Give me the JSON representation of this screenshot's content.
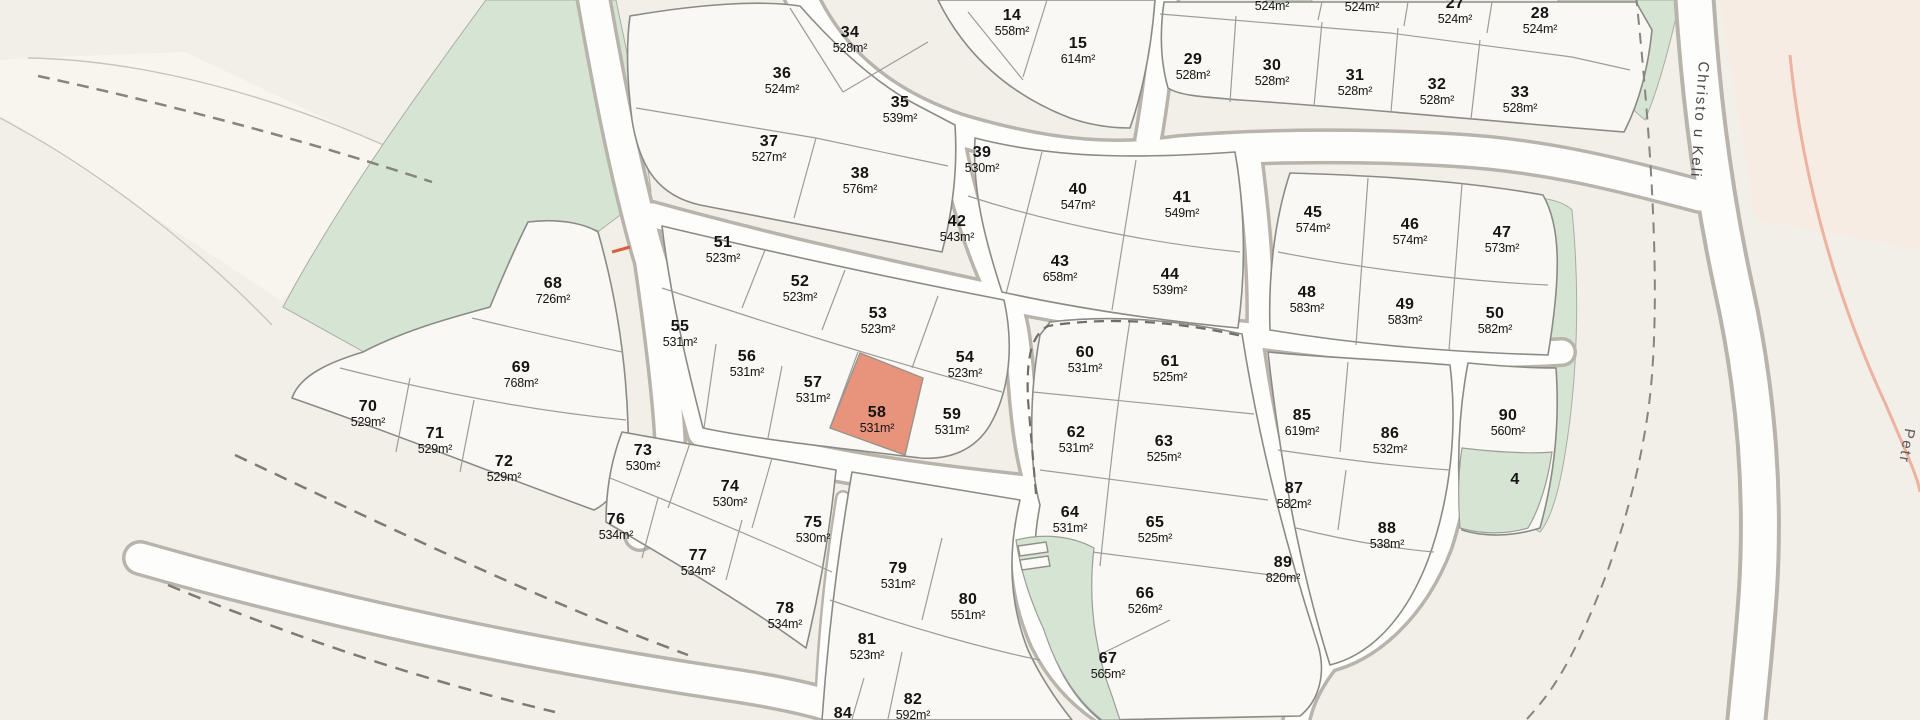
{
  "map": {
    "title": "Parcel subdivision map",
    "colors": {
      "background": "#f2efe9",
      "plot_fill": "#f9f8f4",
      "greenspace": "#d6e4d3",
      "road_fill": "#fdfdfc",
      "road_casing": "#b8b4ab",
      "highlight_fill": "#e8937c",
      "dashed_boundary": "#7c7c76",
      "construction_road_pink": "#edb2a0"
    },
    "highlighted_plot": "58",
    "street_labels": {
      "christo": "Christo u Keli",
      "petr": "Petr"
    },
    "plots": [
      {
        "num": "34",
        "area": "528m²",
        "x": 850,
        "y": 33
      },
      {
        "num": "36",
        "area": "524m²",
        "x": 782,
        "y": 74
      },
      {
        "num": "35",
        "area": "539m²",
        "x": 900,
        "y": 103
      },
      {
        "num": "37",
        "area": "527m²",
        "x": 769,
        "y": 142
      },
      {
        "num": "38",
        "area": "576m²",
        "x": 860,
        "y": 174
      },
      {
        "num": "14",
        "area": "558m²",
        "x": 1012,
        "y": 16
      },
      {
        "num": "15",
        "area": "614m²",
        "x": 1078,
        "y": 44
      },
      {
        "num": null,
        "area": "524m²",
        "x": 1272,
        "y": 8
      },
      {
        "num": "26",
        "area": "524m²",
        "x": 1362,
        "y": -8
      },
      {
        "num": "27",
        "area": "524m²",
        "x": 1455,
        "y": 4
      },
      {
        "num": "28",
        "area": "524m²",
        "x": 1540,
        "y": 14
      },
      {
        "num": "29",
        "area": "528m²",
        "x": 1193,
        "y": 60
      },
      {
        "num": "30",
        "area": "528m²",
        "x": 1272,
        "y": 66
      },
      {
        "num": "31",
        "area": "528m²",
        "x": 1355,
        "y": 76
      },
      {
        "num": "32",
        "area": "528m²",
        "x": 1437,
        "y": 85
      },
      {
        "num": "33",
        "area": "528m²",
        "x": 1520,
        "y": 93
      },
      {
        "num": "39",
        "area": "530m²",
        "x": 982,
        "y": 153
      },
      {
        "num": "42",
        "area": "543m²",
        "x": 957,
        "y": 222
      },
      {
        "num": "40",
        "area": "547m²",
        "x": 1078,
        "y": 190
      },
      {
        "num": "43",
        "area": "658m²",
        "x": 1060,
        "y": 262
      },
      {
        "num": "41",
        "area": "549m²",
        "x": 1182,
        "y": 198
      },
      {
        "num": "44",
        "area": "539m²",
        "x": 1170,
        "y": 275
      },
      {
        "num": "45",
        "area": "574m²",
        "x": 1313,
        "y": 213
      },
      {
        "num": "46",
        "area": "574m²",
        "x": 1410,
        "y": 225
      },
      {
        "num": "47",
        "area": "573m²",
        "x": 1502,
        "y": 233
      },
      {
        "num": "48",
        "area": "583m²",
        "x": 1307,
        "y": 293
      },
      {
        "num": "49",
        "area": "583m²",
        "x": 1405,
        "y": 305
      },
      {
        "num": "50",
        "area": "582m²",
        "x": 1495,
        "y": 314
      },
      {
        "num": "51",
        "area": "523m²",
        "x": 723,
        "y": 243
      },
      {
        "num": "52",
        "area": "523m²",
        "x": 800,
        "y": 282
      },
      {
        "num": "53",
        "area": "523m²",
        "x": 878,
        "y": 314
      },
      {
        "num": "54",
        "area": "523m²",
        "x": 965,
        "y": 358
      },
      {
        "num": "55",
        "area": "531m²",
        "x": 680,
        "y": 327
      },
      {
        "num": "56",
        "area": "531m²",
        "x": 747,
        "y": 357
      },
      {
        "num": "57",
        "area": "531m²",
        "x": 813,
        "y": 383
      },
      {
        "num": "58",
        "area": "531m²",
        "x": 877,
        "y": 413,
        "highlight": true
      },
      {
        "num": "59",
        "area": "531m²",
        "x": 952,
        "y": 415
      },
      {
        "num": "60",
        "area": "531m²",
        "x": 1085,
        "y": 353
      },
      {
        "num": "61",
        "area": "525m²",
        "x": 1170,
        "y": 362
      },
      {
        "num": "62",
        "area": "531m²",
        "x": 1076,
        "y": 433
      },
      {
        "num": "63",
        "area": "525m²",
        "x": 1164,
        "y": 442
      },
      {
        "num": "64",
        "area": "531m²",
        "x": 1070,
        "y": 513
      },
      {
        "num": "65",
        "area": "525m²",
        "x": 1155,
        "y": 523
      },
      {
        "num": "66",
        "area": "526m²",
        "x": 1145,
        "y": 594
      },
      {
        "num": "67",
        "area": "565m²",
        "x": 1108,
        "y": 659
      },
      {
        "num": "68",
        "area": "726m²",
        "x": 553,
        "y": 284
      },
      {
        "num": "69",
        "area": "768m²",
        "x": 521,
        "y": 368
      },
      {
        "num": "70",
        "area": "529m²",
        "x": 368,
        "y": 407
      },
      {
        "num": "71",
        "area": "529m²",
        "x": 435,
        "y": 434
      },
      {
        "num": "72",
        "area": "529m²",
        "x": 504,
        "y": 462
      },
      {
        "num": "73",
        "area": "530m²",
        "x": 643,
        "y": 451
      },
      {
        "num": "74",
        "area": "530m²",
        "x": 730,
        "y": 487
      },
      {
        "num": "75",
        "area": "530m²",
        "x": 813,
        "y": 523
      },
      {
        "num": "76",
        "area": "534m²",
        "x": 616,
        "y": 520
      },
      {
        "num": "77",
        "area": "534m²",
        "x": 698,
        "y": 556
      },
      {
        "num": "78",
        "area": "534m²",
        "x": 785,
        "y": 609
      },
      {
        "num": "79",
        "area": "531m²",
        "x": 898,
        "y": 569
      },
      {
        "num": "80",
        "area": "551m²",
        "x": 968,
        "y": 600
      },
      {
        "num": "81",
        "area": "523m²",
        "x": 867,
        "y": 640
      },
      {
        "num": "82",
        "area": "592m²",
        "x": 913,
        "y": 700
      },
      {
        "num": "84",
        "area": null,
        "x": 843,
        "y": 714
      },
      {
        "num": "85",
        "area": "619m²",
        "x": 1302,
        "y": 416
      },
      {
        "num": "86",
        "area": "532m²",
        "x": 1390,
        "y": 434
      },
      {
        "num": "87",
        "area": "582m²",
        "x": 1294,
        "y": 489
      },
      {
        "num": "88",
        "area": "538m²",
        "x": 1387,
        "y": 529
      },
      {
        "num": "89",
        "area": "820m²",
        "x": 1283,
        "y": 563
      },
      {
        "num": "90",
        "area": "560m²",
        "x": 1508,
        "y": 416
      },
      {
        "num": "4",
        "area": null,
        "x": 1515,
        "y": 480
      }
    ]
  }
}
